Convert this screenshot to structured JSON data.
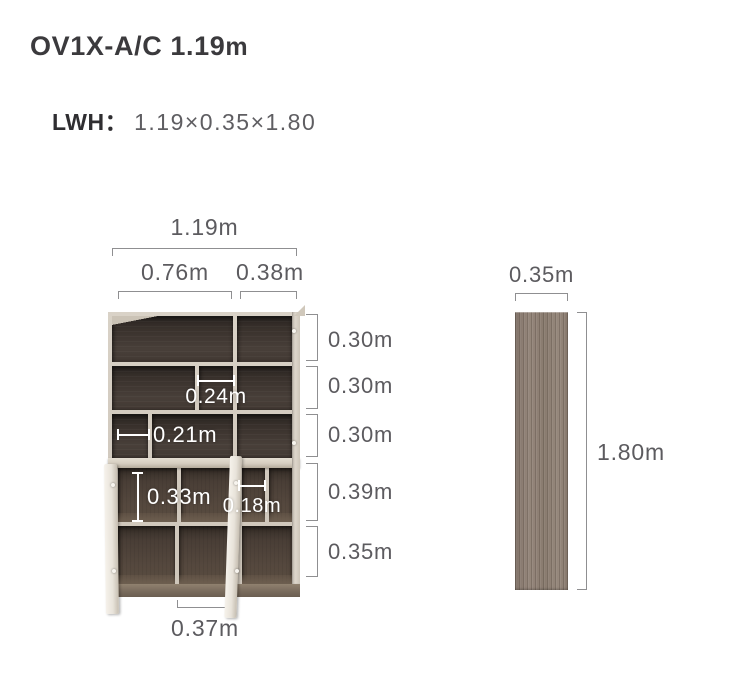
{
  "header": {
    "title_main": "OV1X-A/C 1.19",
    "title_unit": "m",
    "lwh_label": "LWH：",
    "lwh_value": "1.19×0.35×1.80"
  },
  "front_view": {
    "total_width": "1.19m",
    "left_section_width": "0.76m",
    "right_section_width": "0.38m",
    "section_heights": [
      "0.30m",
      "0.30m",
      "0.30m",
      "0.39m",
      "0.35m"
    ],
    "shelf_inner_width": "0.24m",
    "shelf_inner_width_small": "0.21m",
    "cabinet_inner_height": "0.33m",
    "cabinet_inner_width": "0.18m",
    "door_width": "0.37m"
  },
  "side_view": {
    "depth": "0.35m",
    "height": "1.80m"
  },
  "colors": {
    "title_text": "#3b3a3d",
    "dim_text": "#5c5b5f",
    "dim_line": "#8f8f91",
    "annotation_text": "#ffffff",
    "frame_wood": "#d3cbc0",
    "interior_dark": "#3a322e",
    "interior_low": "#55483e",
    "side_panel_wood": "#8c7d72"
  }
}
